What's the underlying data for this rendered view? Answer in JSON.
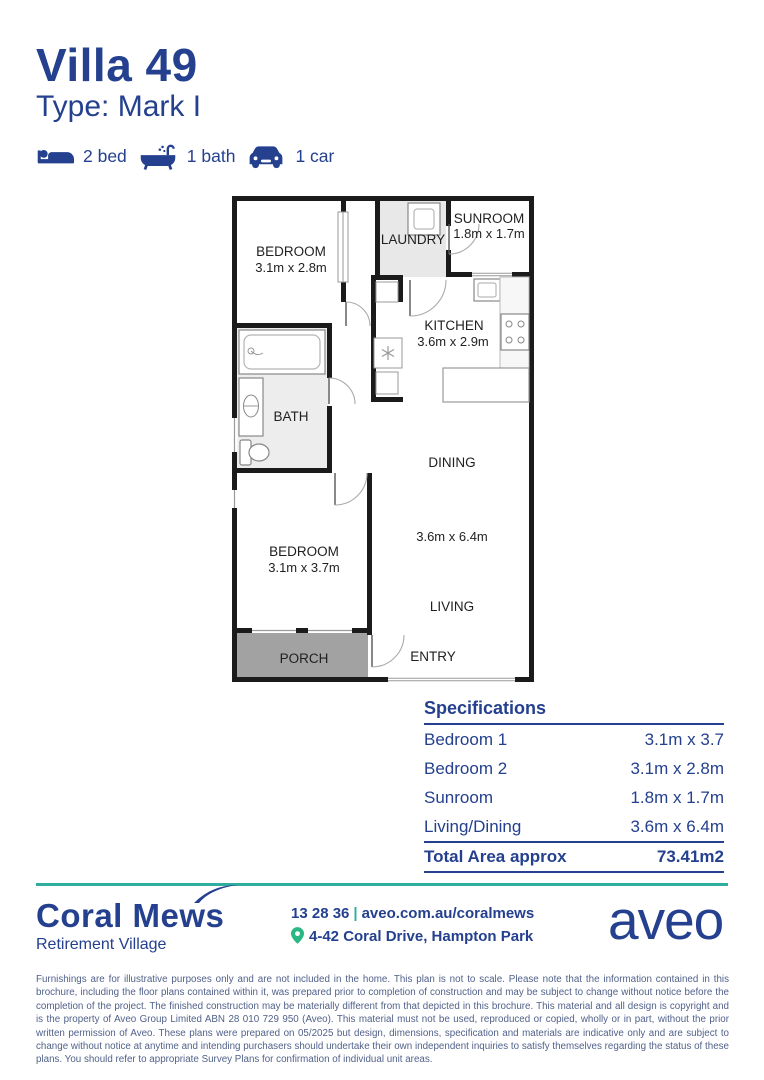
{
  "page": {
    "title": "Villa 49",
    "subtitle": "Type: Mark I"
  },
  "features": [
    {
      "icon": "bed-icon",
      "label": "2 bed"
    },
    {
      "icon": "bath-icon",
      "label": "1 bath"
    },
    {
      "icon": "car-icon",
      "label": "1 car"
    }
  ],
  "floorplan": {
    "bedroom2": {
      "name": "BEDROOM",
      "dims": "3.1m x 2.8m"
    },
    "laundry": {
      "name": "LAUNDRY"
    },
    "sunroom": {
      "name": "SUNROOM",
      "dims": "1.8m x 1.7m"
    },
    "kitchen": {
      "name": "KITCHEN",
      "dims": "3.6m x 2.9m"
    },
    "bath": {
      "name": "BATH"
    },
    "dining": {
      "name": "DINING"
    },
    "living_dining_dims": "3.6m x 6.4m",
    "bedroom1": {
      "name": "BEDROOM",
      "dims": "3.1m x 3.7m"
    },
    "living": {
      "name": "LIVING"
    },
    "porch": {
      "name": "PORCH"
    },
    "entry": {
      "name": "ENTRY"
    }
  },
  "specifications": {
    "title": "Specifications",
    "rows": [
      {
        "label": "Bedroom 1",
        "value": "3.1m x 3.7"
      },
      {
        "label": "Bedroom 2",
        "value": "3.1m x 2.8m"
      },
      {
        "label": "Sunroom",
        "value": "1.8m x 1.7m"
      },
      {
        "label": "Living/Dining",
        "value": "3.6m x 6.4m"
      }
    ],
    "total_label": "Total Area approx",
    "total_value": "73.41m2"
  },
  "footer": {
    "brand": "Coral Mews",
    "brand_sub": "Retirement Village",
    "phone": "13 28 36",
    "separator": "|",
    "website": "aveo.com.au/coralmews",
    "address": "4-42 Coral Drive, Hampton Park",
    "logo": "aveo"
  },
  "disclaimer": "Furnishings are for illustrative purposes only and are not included in the home. This plan is not to scale. Please note that the information contained in this brochure, including the floor plans contained within it, was prepared prior to completion of construction and may be subject to change without notice before the completion of the project. The finished construction may be materially different from that depicted in this brochure. This material and all design is copyright and is the property of Aveo Group Limited ABN 28 010 729 950 (Aveo). This material must not be used, reproduced or copied, wholly or in part, without the prior written permission of Aveo. These plans were prepared on 05/2025 but design, dimensions, specification and materials are indicative only and are subject to change without notice at anytime and intending purchasers should undertake their own independent inquiries to satisfy themselves regarding the status of these plans. You should refer to appropriate Survey Plans for confirmation of individual unit areas.",
  "colors": {
    "navy": "#24408e",
    "teal": "#2fae9f",
    "pin_green": "#29b785"
  }
}
